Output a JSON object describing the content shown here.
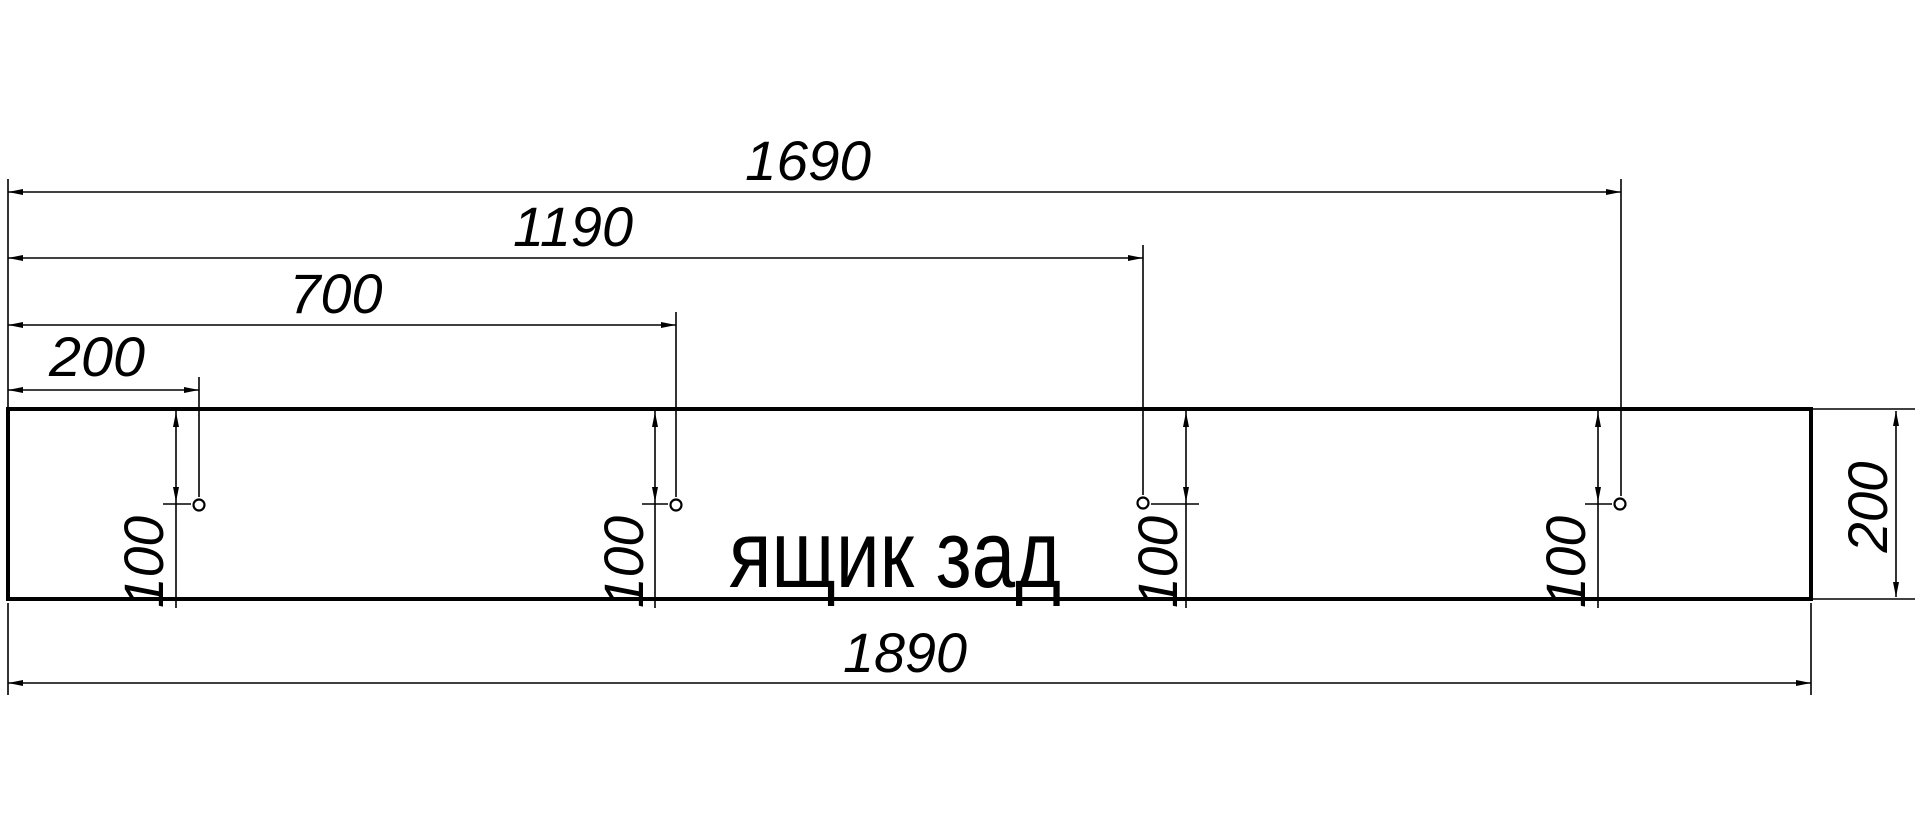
{
  "page": {
    "background": "#ffffff",
    "line_color": "#000000"
  },
  "drawing": {
    "type": "dimensioned-panel-drawing",
    "part_label": "ящик зад",
    "panel": {
      "x": 8,
      "y": 409,
      "width": 1803,
      "height": 190,
      "stroke_width": 4
    },
    "holes": [
      {
        "cx": 199,
        "cy": 505,
        "r": 5.5
      },
      {
        "cx": 676,
        "cy": 505,
        "r": 5.5
      },
      {
        "cx": 1143,
        "cy": 503,
        "r": 5.5
      },
      {
        "cx": 1620,
        "cy": 504,
        "r": 5.5
      }
    ],
    "left_extension": {
      "x": 8,
      "y1": 179,
      "y2": 409
    },
    "top_dims": [
      {
        "value": "1690",
        "y": 192,
        "x1": 8,
        "x2": 1621,
        "label_x": 808,
        "label_baseline": 180,
        "label_length": 126,
        "ext_top": 179,
        "hole": 3
      },
      {
        "value": "1190",
        "y": 258,
        "x1": 8,
        "x2": 1143,
        "label_x": 573,
        "label_baseline": 246,
        "label_length": 120,
        "ext_top": 245,
        "hole": 2
      },
      {
        "value": "700",
        "y": 325,
        "x1": 8,
        "x2": 676,
        "label_x": 336,
        "label_baseline": 313,
        "label_length": 93,
        "ext_top": 312,
        "hole": 1
      },
      {
        "value": "200",
        "y": 390,
        "x1": 8,
        "x2": 199,
        "label_x": 97,
        "label_baseline": 376,
        "label_length": 96,
        "ext_top": 377,
        "hole": 0
      }
    ],
    "bottom_dim": {
      "value": "1890",
      "y": 683,
      "x1": 8,
      "x2": 1811,
      "label_x": 905,
      "label_baseline": 672,
      "label_length": 124,
      "ext": [
        {
          "x": 8,
          "y1": 603,
          "y2": 695
        },
        {
          "x": 1811,
          "y1": 603,
          "y2": 695
        }
      ]
    },
    "right_dim": {
      "value": "200",
      "x": 1896,
      "y1": 411,
      "y2": 597,
      "label_tx": 1887,
      "label_ty": 507,
      "label_length": 91,
      "ext": [
        {
          "y": 409,
          "x1": 1813,
          "x2": 1915
        },
        {
          "y": 599,
          "x1": 1813,
          "x2": 1915
        }
      ]
    },
    "hole_offset_dims": {
      "line_top": 411,
      "line_bottom": 608,
      "arrow_top_tip": 412,
      "arrow_bottom_tip": 502,
      "tick_y": 504,
      "items": [
        {
          "value": "100",
          "line_x": 176,
          "tick_x1": 163,
          "tick_x2": 191,
          "text_x": 163,
          "text_y": 562
        },
        {
          "value": "100",
          "line_x": 655,
          "tick_x1": 642,
          "tick_x2": 668,
          "text_x": 643,
          "text_y": 562
        },
        {
          "value": "100",
          "line_x": 1186,
          "tick_x1": 1151,
          "tick_x2": 1199,
          "text_x": 1177,
          "text_y": 562
        },
        {
          "value": "100",
          "line_x": 1598,
          "tick_x1": 1585,
          "tick_x2": 1612,
          "text_x": 1585,
          "text_y": 562
        }
      ]
    }
  }
}
